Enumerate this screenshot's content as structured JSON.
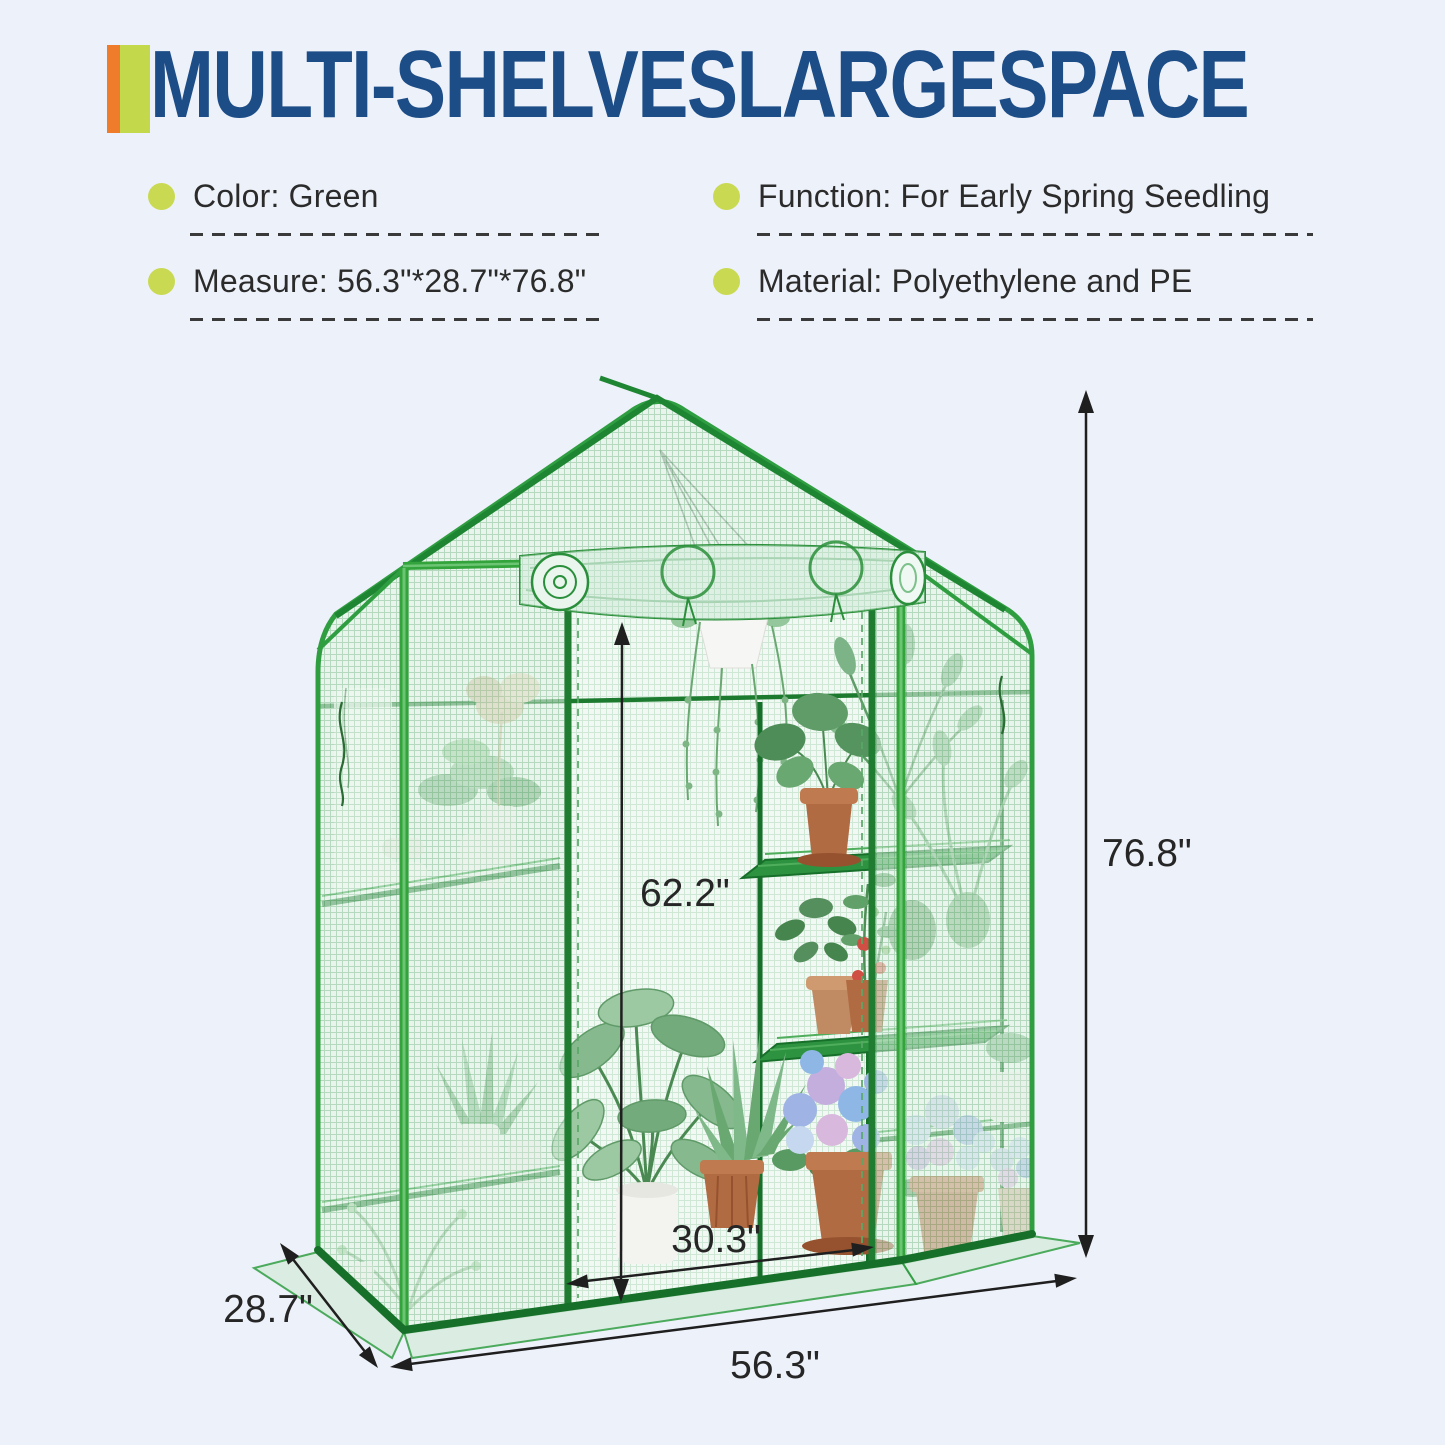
{
  "page": {
    "background": "#edf1f9"
  },
  "header": {
    "title": "MULTI-SHELVESLARGESPACE",
    "title_color": "#1d4d87",
    "accent_orange": "#ee7c2b",
    "accent_green": "#c3d84a"
  },
  "features": {
    "bullet_color": "#c9da52",
    "items": [
      {
        "id": "color",
        "label": "Color: Green"
      },
      {
        "id": "function",
        "label": "Function: For Early Spring Seedling"
      },
      {
        "id": "measure",
        "label": "Measure: 56.3\"*28.7\"*76.8\""
      },
      {
        "id": "material",
        "label": "Material: Polyethylene and PE"
      }
    ]
  },
  "diagram": {
    "product_name": "walk-in greenhouse with multi shelves and roll-up door",
    "labels": {
      "overall_height": "76.8\"",
      "interior_height": "62.2\"",
      "door_width": "30.3\"",
      "overall_width": "56.3\"",
      "overall_depth": "28.7\""
    },
    "colors": {
      "frame_green": "#2f9e41",
      "frame_dark_green": "#17702a",
      "post_bright_green": "#33a43c",
      "mesh_background": "#e3f1e7",
      "mesh_grid": "#a3d0ae",
      "dimension_line": "#1f1f1f",
      "terracotta_pot": "#b06b42",
      "hydrangea_blue": "#8fb7e6",
      "hydrangea_lavender": "#c3aede"
    }
  }
}
